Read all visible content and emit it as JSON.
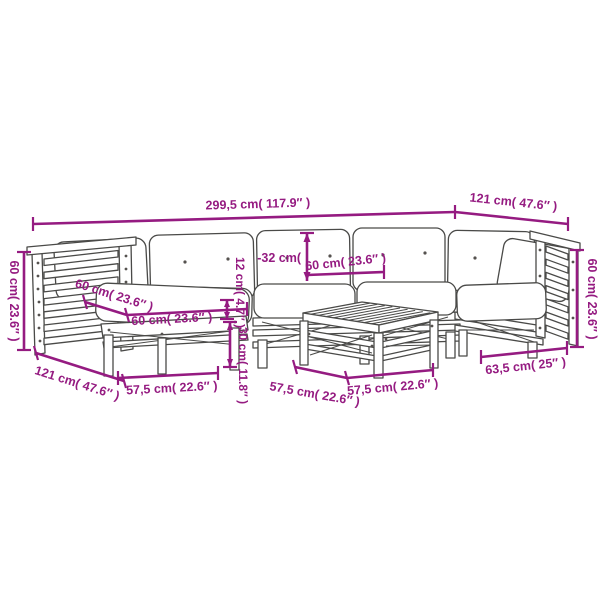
{
  "diagram": {
    "type": "furniture-dimension-diagram",
    "subject": "garden lounge sofa set with cushions (line drawing)",
    "colors": {
      "dimension": "#951b81",
      "line_art": "#4a4a48",
      "background": "#ffffff"
    },
    "labels": {
      "total_width": "299,5 cm( 117.9″ )",
      "top_depth": "121 cm( 47.6″ )",
      "left_height": "60 cm( 23.6″ )",
      "left_depth": "121 cm( 47.6″ )",
      "ottoman_depth": "60 cm( 23.6″ )",
      "ottoman_width": "60 cm( 23.6″ )",
      "back_cushion_partial": "-32 cm(",
      "seat_width": "60 cm( 23.6″ )",
      "cushion_thickness": "12 cm( 4.7″ )",
      "frame_height": "30 cm( 11.8″ )",
      "ottoman_base_width": "57,5 cm( 22.6″ )",
      "table_depth": "57,5 cm( 22.6″ )",
      "table_width": "57,5 cm( 22.6″ )",
      "corner_module_width": "63,5 cm( 25″ )",
      "right_height": "60 cm( 23.6″ )"
    }
  }
}
